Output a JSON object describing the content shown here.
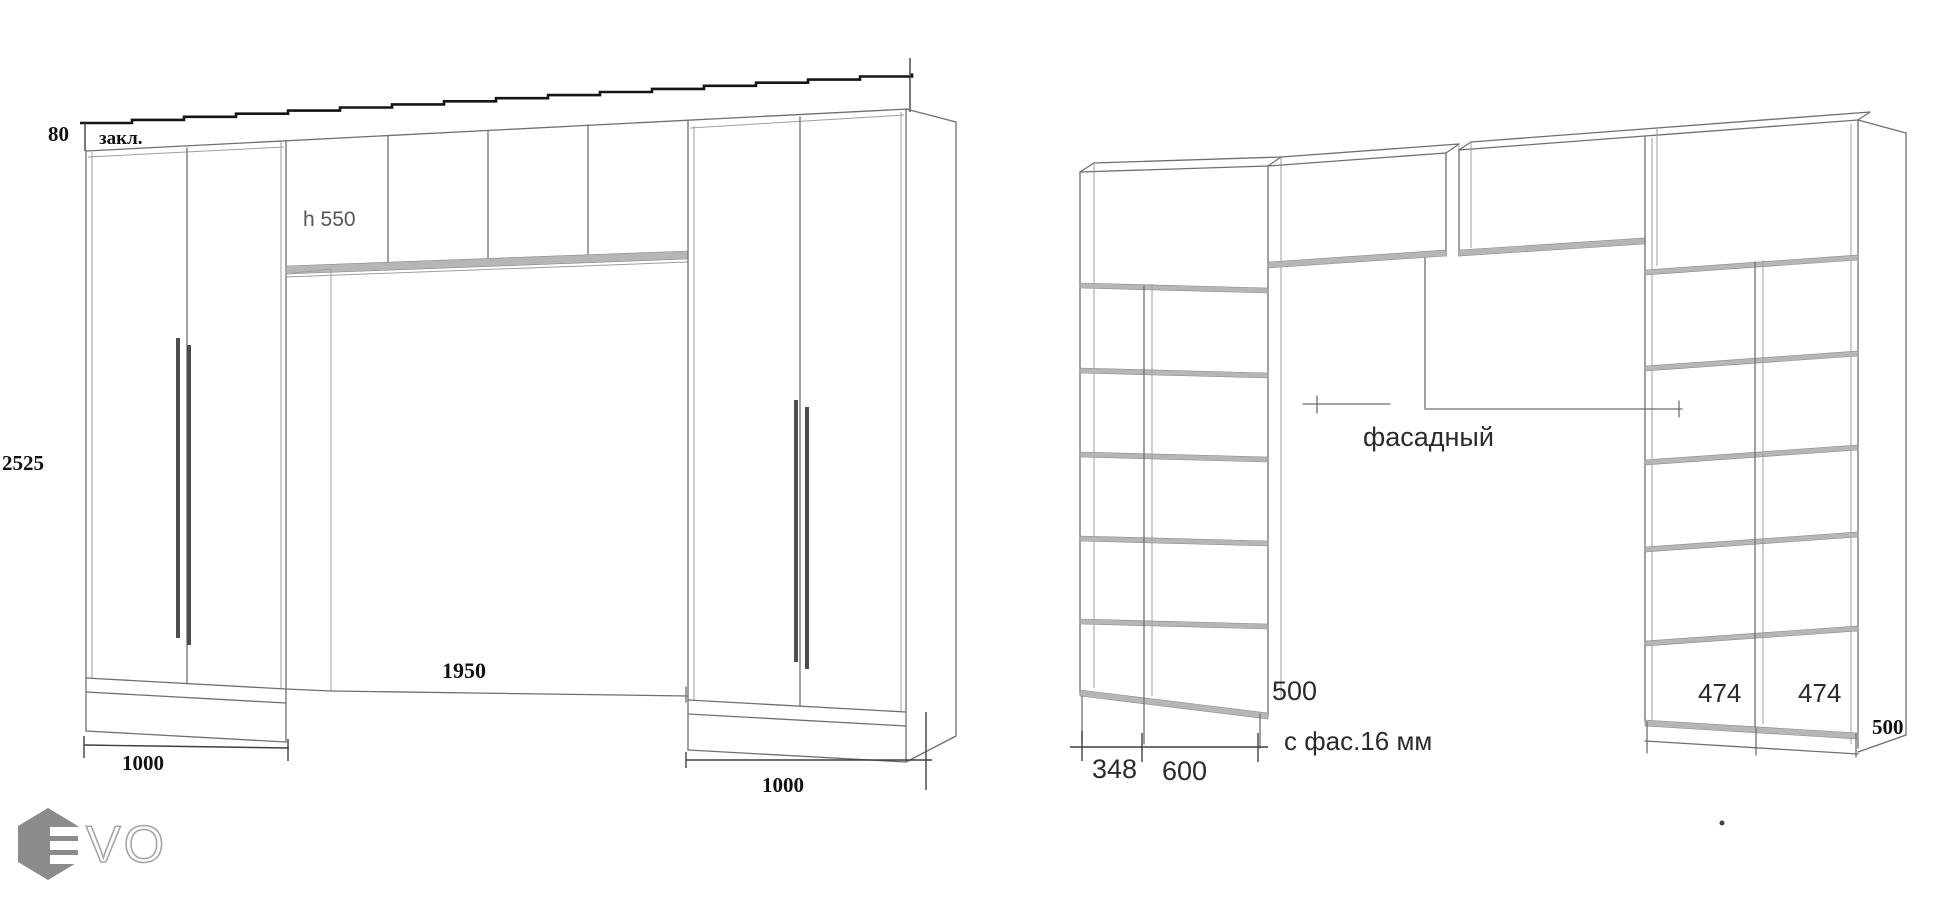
{
  "colors": {
    "line": "#6f6f6f",
    "dark_line": "#3f3f3f",
    "dimension_line": "#151515",
    "shelf_band": "#b6b6b6",
    "text_dark": "#111111",
    "text_gray": "#555555",
    "logo_hexagon": "#8c8c8c",
    "logo_outline": "#a6a6a6"
  },
  "left_view": {
    "top_thickness": "80",
    "top_strip_label": "закл.",
    "upper_cabinet_height": "h 550",
    "total_height": "2525",
    "opening_width": "1950",
    "left_unit_width": "1000",
    "right_unit_width": "1000"
  },
  "right_view": {
    "facade_label": "фасадный",
    "left_tower_depth": "500",
    "col1_width": "348",
    "col2_width": "600",
    "facade_note": "с фас.16 мм",
    "cell1_width": "474",
    "cell2_width": "474",
    "right_tower_depth": "500"
  },
  "logo": {
    "wordmark": "VO"
  }
}
